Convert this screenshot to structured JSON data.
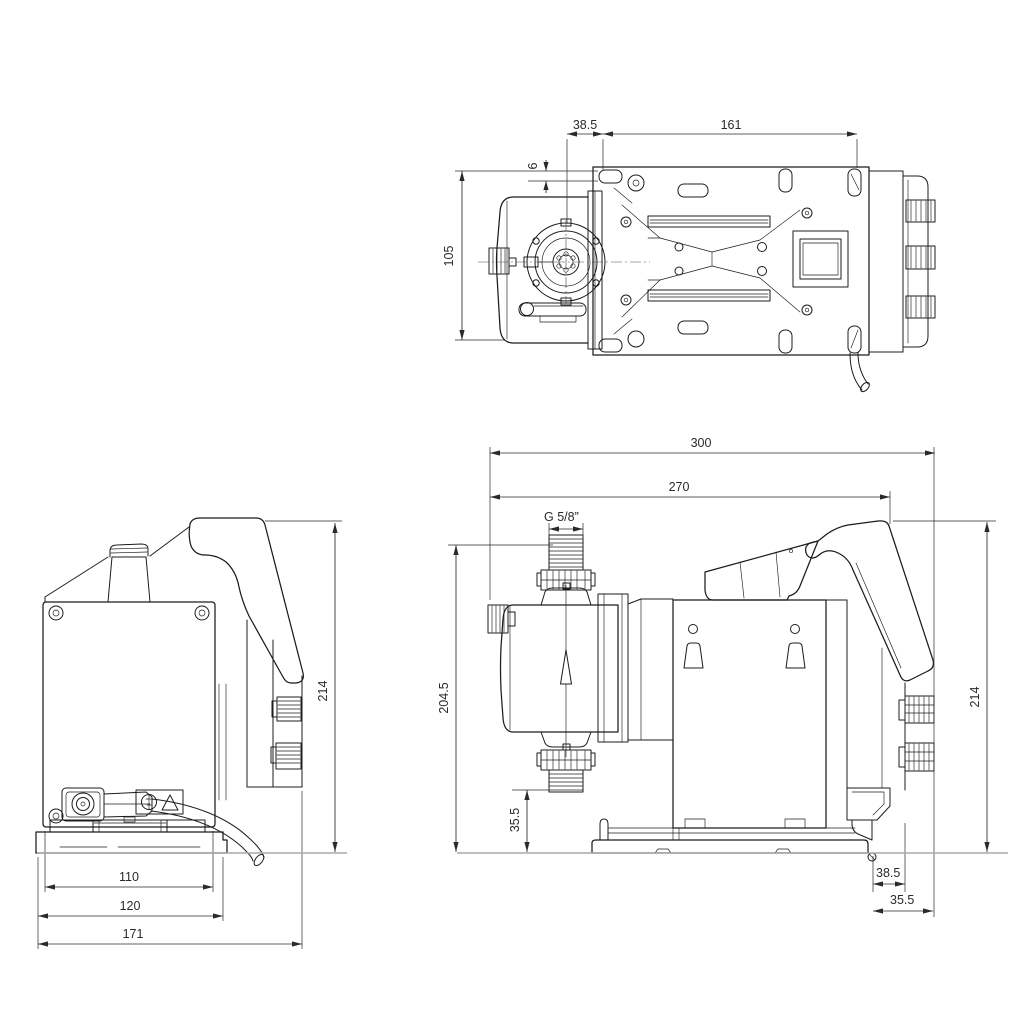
{
  "page": {
    "background": "#ffffff"
  },
  "drawing": {
    "kind": "dimensional-outline-drawing",
    "views": [
      "top",
      "front",
      "side"
    ],
    "colors": {
      "line": "#1c1c1c",
      "dimension": "#2a2a2a",
      "ground_line": "#a9a9a9"
    }
  },
  "dims": {
    "top": {
      "head_offset": "38.5",
      "mounting_span": "161",
      "slot_height": "6",
      "body_width": "105"
    },
    "front": {
      "overall_height": "214",
      "panel_width": "110",
      "base_width": "120",
      "overall_width": "171"
    },
    "side": {
      "overall_depth": "300",
      "body_depth": "270",
      "thread_size": "G 5/8”",
      "hydraulic_top_height": "204.5",
      "outlet_height": "35.5",
      "overall_height": "214",
      "knob_offset": "38.5",
      "knob_depth": "35.5"
    }
  }
}
